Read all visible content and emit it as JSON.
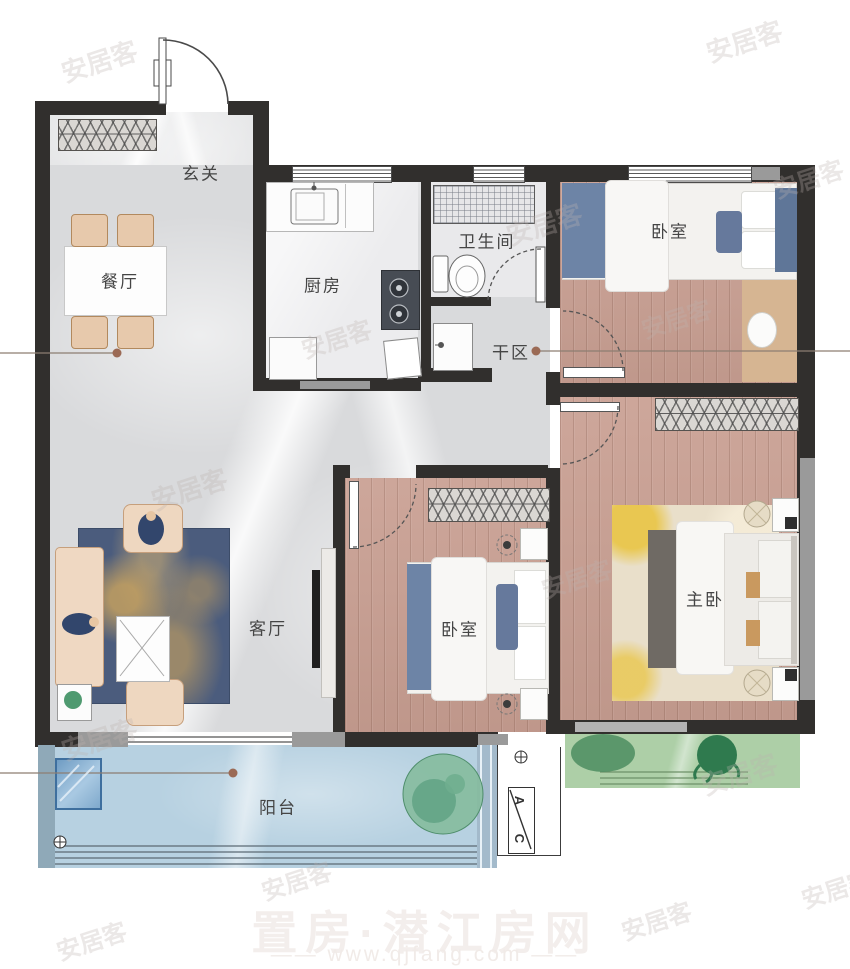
{
  "brand_watermark": {
    "text": "安居客"
  },
  "footer_watermark": {
    "title": "置房·潜江房网",
    "url_prefix": "——",
    "url": "www.qjfang.com",
    "url_suffix": "——"
  },
  "rooms": {
    "entry": {
      "label": "玄关"
    },
    "dining": {
      "label": "餐厅"
    },
    "kitchen": {
      "label": "厨房"
    },
    "bathroom": {
      "label": "卫生间"
    },
    "dry_area": {
      "label": "干区"
    },
    "bedroom_top": {
      "label": "卧室"
    },
    "bedroom_mid": {
      "label": "卧室"
    },
    "master": {
      "label": "主卧"
    },
    "living": {
      "label": "客厅"
    },
    "balcony": {
      "label": "阳台"
    }
  },
  "ac_unit": {
    "top": "A",
    "bottom": "C"
  },
  "colors": {
    "wall": "#312f2d",
    "wall_gray": "#9a9a9a",
    "marble_floor": "#d9dadc",
    "wood_floor": "#c99f92",
    "balcony_floor": "#b7d1e1",
    "green_platform": "#adcfa7",
    "leader_dot": "#9b6a55"
  }
}
